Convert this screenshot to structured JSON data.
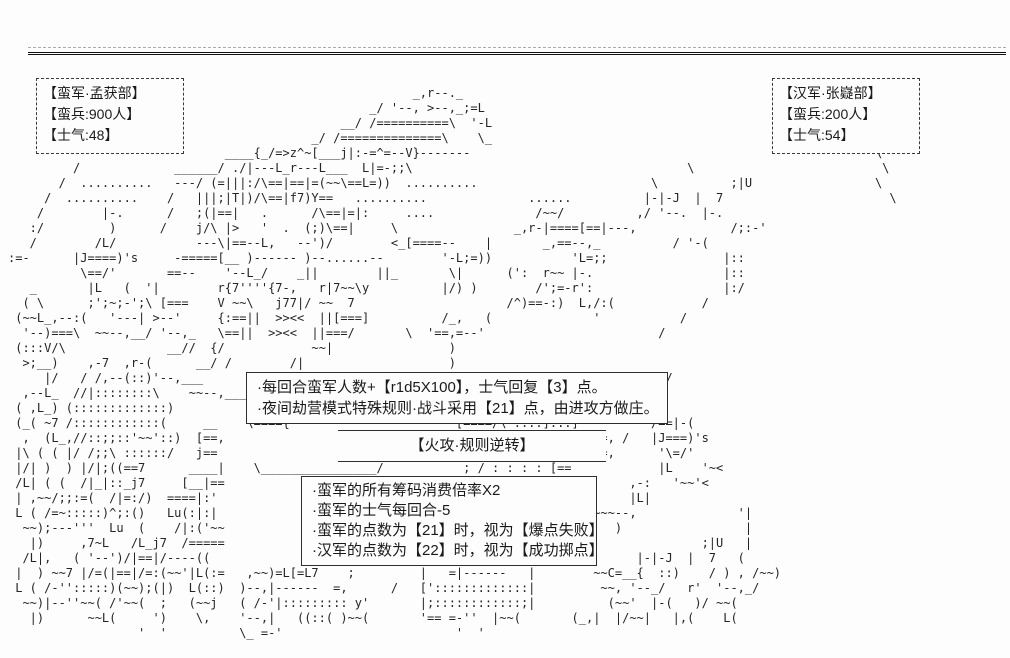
{
  "screen": {
    "background": "#fdfdfd",
    "ink": "#1a1a1a"
  },
  "left_army": {
    "name": "【蛮军·孟获部】",
    "troops": "【蛮兵:900人】",
    "morale": "【士气:48】"
  },
  "right_army": {
    "name": "【汉军·张嶷部】",
    "troops": "【蛮兵:200人】",
    "morale": "【士气:54】"
  },
  "turn_rules": {
    "line1": "·每回合蛮军人数+【r1d5X100】，士气回复【3】点。",
    "line2": "·夜间劫营模式特殊规则·战斗采用【21】点，由进攻方做庄。"
  },
  "banner": {
    "label": "【火攻·规则逆转】"
  },
  "reversal_rules": {
    "line1": "·蛮军的所有筹码消费倍率X2",
    "line2": "·蛮军的士气每回合-5",
    "line3": "·蛮军的点数为【21】时，视为【爆点失败】",
    "line4": "·汉军的点数为【22】时，视为【成功掷点】"
  },
  "ascii_scene": {
    "lines": [
      "",
      "",
      "                                                        _,r--._",
      "                                                  _/ '--, >--,_;=L",
      "                                              __/ /==========\\  '-L",
      "                                          _/ /==============\\    \\_",
      "                              ____{_/=>z^~[___j|:-=^=--V}-------                                                        \\",
      "         /             ______/ ./|---L_r---L___  L|=-;;\\                                      \\                          \\",
      "       /  ..........   ---/ (=|||:/\\==|==|=(~~\\==L=))  ..........                        \\          ;|U                 \\",
      "     /  ..........    /   |||;|T|)/\\==|f7)Y==   ..........              ......          |-|-J  |  7                       \\",
      "    /        |-.      /   ;(|==|   .      /\\==|=|:     ....              /~~/          ,/ '--.  |-.",
      "   :/         )      /    j/\\ |>   '  .  (;)\\==|     \\                _,r-|====[==|---,             /;:-'",
      "   /        /L/           ---\\|==--L,   --')/        <_[====--    |       _,==--,_          / '-(",
      ":=-      |J====)'s     -=====[__ )------ )--......--        '-L;=))           'L=;;                |::",
      "          \\==/'       ==--    '--L_/    _||        ||_       \\|      (':  r~~ |-.                  |::",
      "   _       |L   (  '|        r{7''''{7-,   r|7~~\\y          |/) )        /';=-r':                  |:/",
      "  ( \\      ;';~;-';\\ [===    V ~~\\   j77|/ ~~  7                     /^)==-:)  L,/:(            /",
      " (~~L_,--:(   '---| >--'     {:==||  >><<  ||[===]          /_,   (              '           /",
      "  '--)===\\  ~~--,__/ '--,_   \\==||  >><<  ||===/       \\  '==,=--'                        /",
      " (:::V/\\              __//  {/            ~~|                )",
      "  >;__)    ,-7  ,r-(      __/ /        /|                    )",
      "     |/   / /,--(::)'--,___                                                | ]          _/L/",
      "  ,--L_  //|::::::::\\    ~~--,____                                         | ]        /=:/",
      " ( ,L_) (:::::::::::::)                                                    |_,/          '",
      " (_( ~7 /::::::::::::(     __    \\===={                       [====/\\ ::::]:::]          /==|-(",
      "  ,  (L_,//::;;::'~~'::)  [==,                                  \\ :::::::::::    ==, /   |J===)'s",
      " |\\ ( ( |/ /;;\\ ::::::/   j==                                   /\\ ::::::::/:::: ,=,      '\\=/'",
      " |/| )  ) |/|;((==7      ____|    \\________________/           ; / : : : : [==            |L    '~<",
      " /L| ( (  /|_|::_j7     [__|==                                 : : : :  )==)          ,-:   '~~'<",
      " | ,~~/;;:=(  /|=:/)  ====|:'                                  : /  ~=|  j==,         |L|",
      " L ( /=~:::::)^;:()   Lu(:|:|                                  )|~~(   (         ~~~--,              '|",
      "  ~~);---'''  Lu  (    /|:('~~                                 L|:=/  /~~|          )                 |",
      "   |)     ,7~L   /L_j7  /=====                                 (  \\,  '~~)  (','                ;|U   |",
      "  /L|,   ( '--')/|==|/----((                                   /==/ ,;(  ~~)|)         |-|-J  |  7   (",
      " |  ) ~~7 |/=(|==|/=:(~~'|L(:=   ,~~)=L[=L7    ;         |   =|------   |        ~~C=__{  ::)    / ) , /~~)",
      " L ( /-'':::::)(~~);(|)  L(::)  )--,|------  =,      /   [':::::::::::::|         ~~, '--_/   r'  '--,_/",
      "  ~~)|--''~~( /'~~(  ;   (~~j   ( /-'|::::::::: y'       |;::::::::::::;|          (~~'  |-(   )/ ~~(",
      "   |)      ~~L(     ')    \\,    '--,|   ((::( )~~(       '== =-''  |~~(       (_,|  |/~~|   |,(    L(",
      "                  '  '          \\_ =-'                        '  '",
      ""
    ]
  }
}
